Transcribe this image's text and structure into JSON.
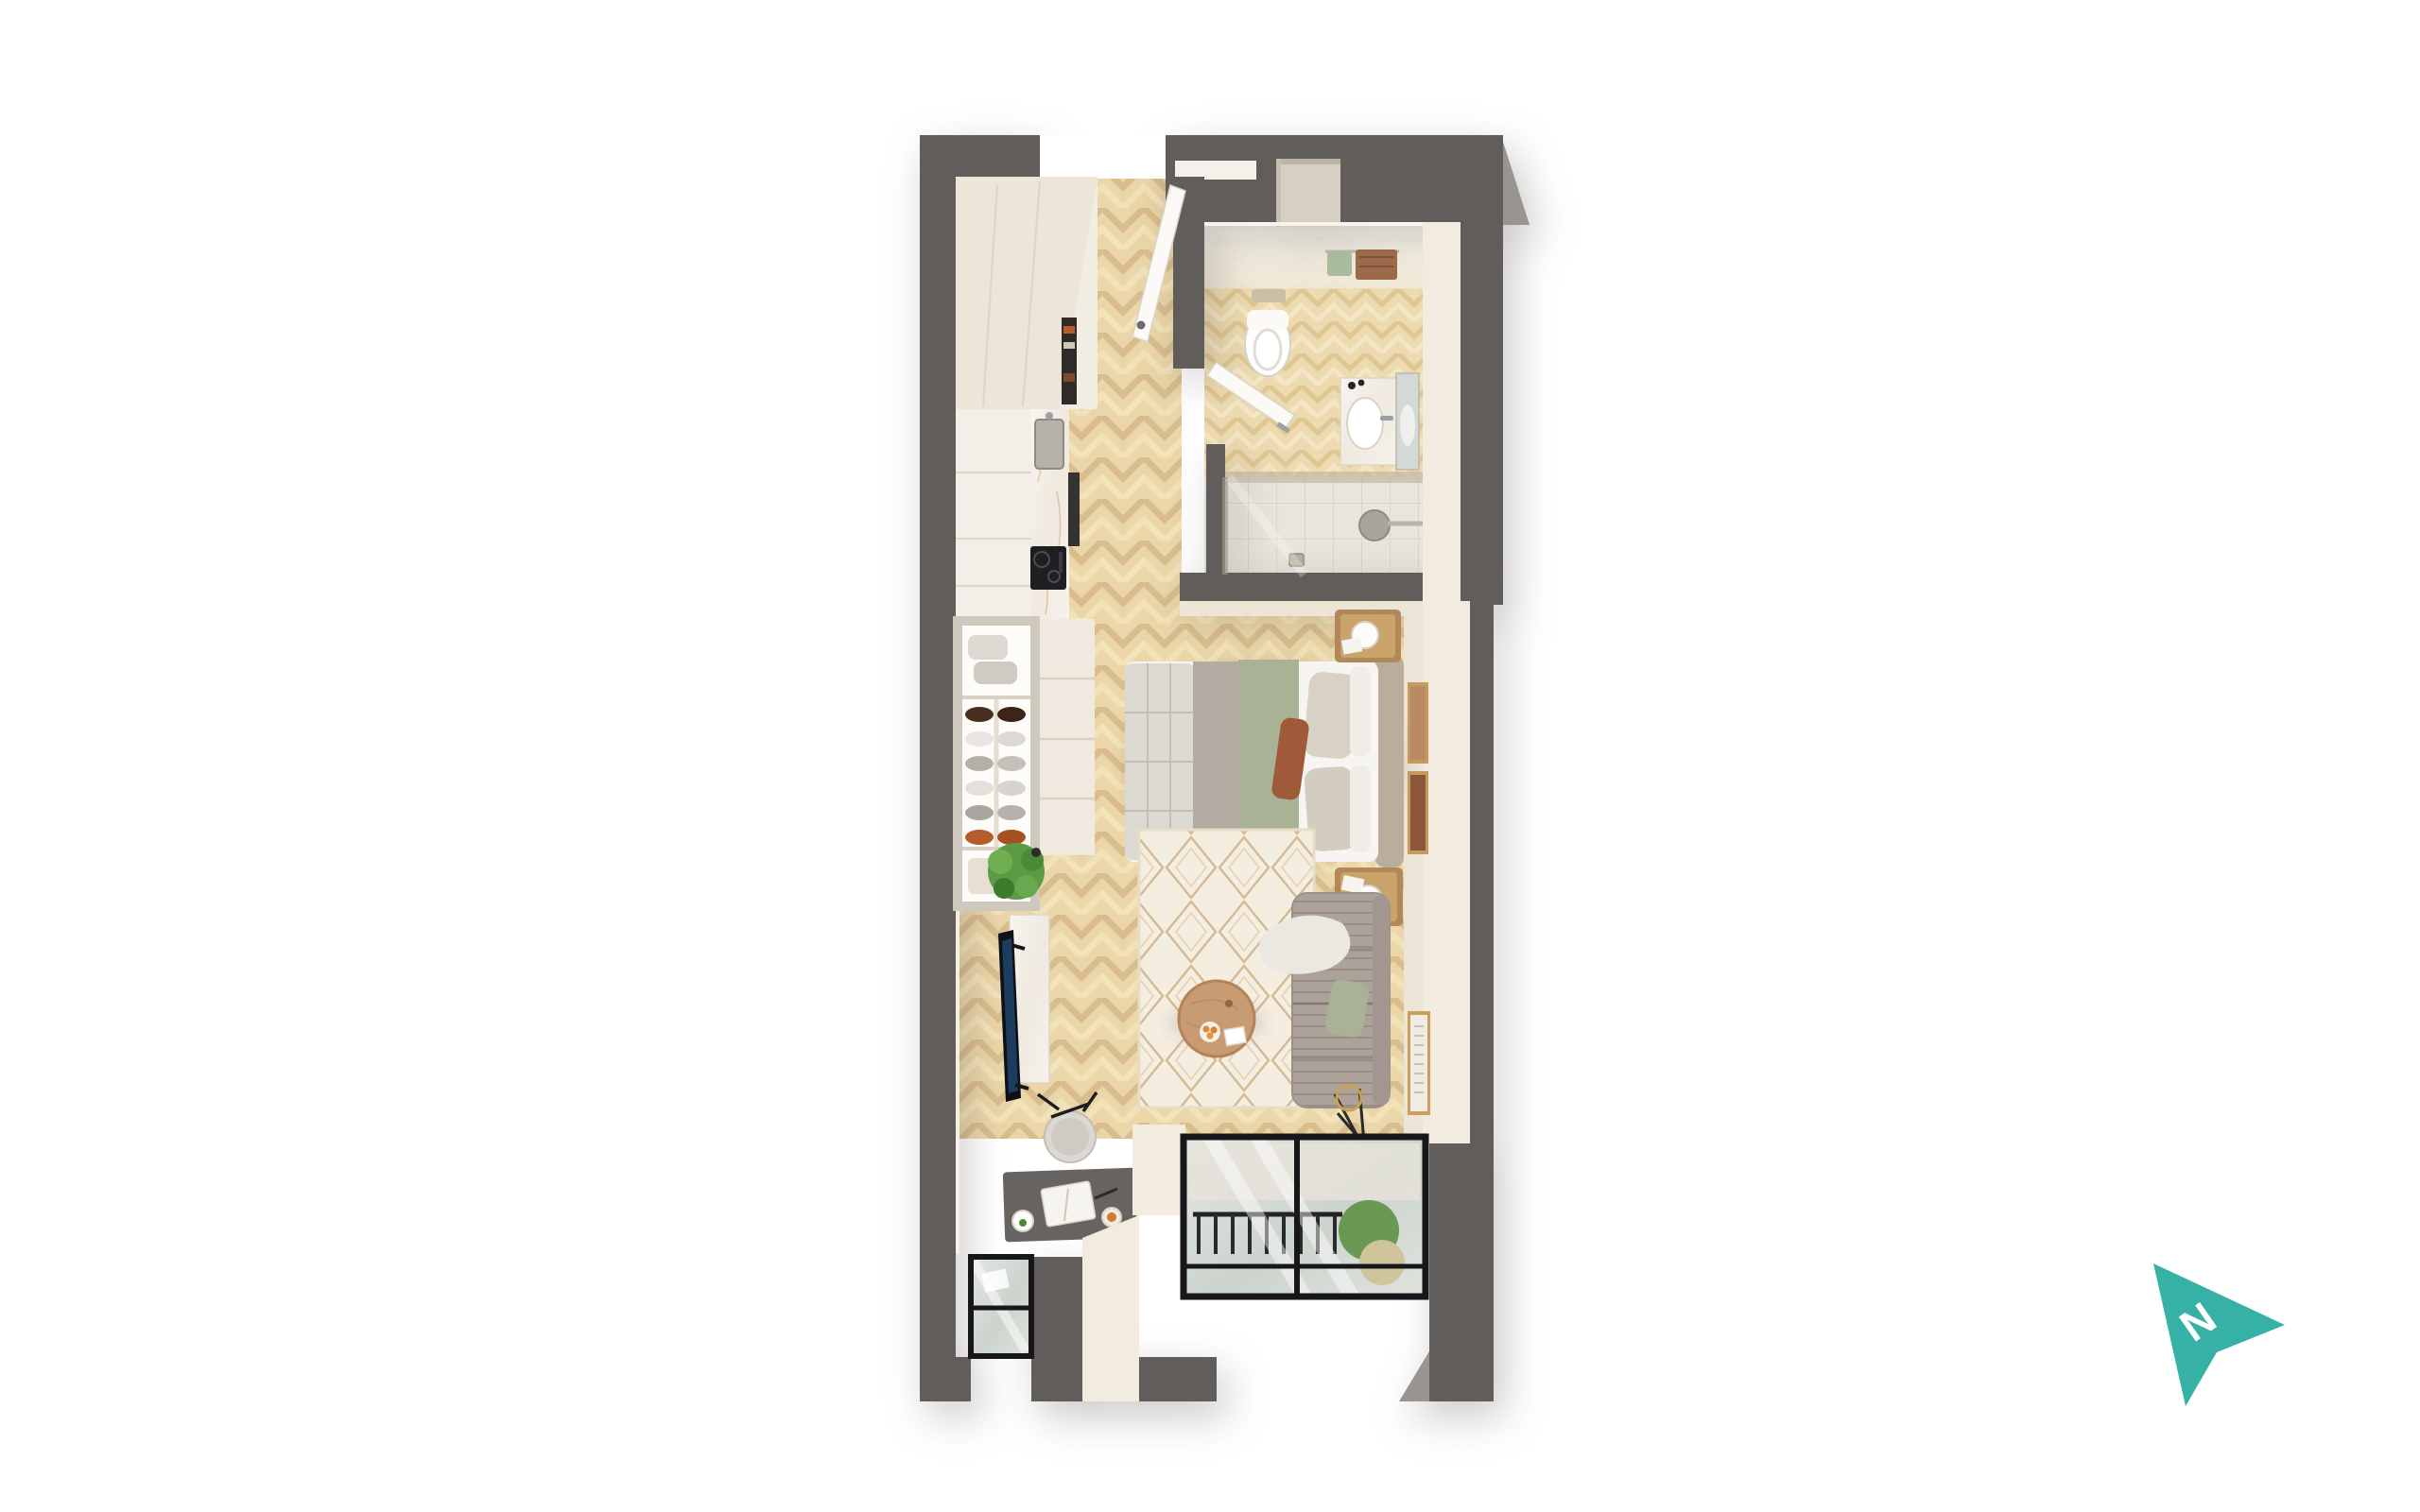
{
  "scene": {
    "type": "3d-floor-plan-render",
    "description": "Top-down 3D render of a studio apartment on a white background",
    "compass": {
      "label": "N",
      "pointing": "right",
      "color": "#35b2a5"
    }
  },
  "palette": {
    "wall-dark": "#615d5a",
    "wall-bevel": "#98948f",
    "cream-light": "#f1ebe0",
    "cream-mid": "#e6decf",
    "wood-floor": "#ead6a8",
    "bath-floor": "#ecdab0",
    "shower-tile": "#e9e5dc",
    "marble": "#f6f2ec",
    "rug": "#f4eee1",
    "rug-lattice": "#c9a883",
    "sofa-gray": "#aca29a",
    "bed-white": "#f7f5f1",
    "sage-green": "#a9b295",
    "rust": "#9f5a39",
    "table-wood": "#c99b72",
    "plant-green": "#5d9a44",
    "tv-screen": "#1d3d5e",
    "accent-teal": "#35b2a5",
    "glass": "#d6dcd7",
    "frame-black": "#17171a"
  },
  "rooms": [
    {
      "name": "entry-hall",
      "floor": "herringbone-wood",
      "items": [
        "entry-door-open",
        "closet-door-open",
        "hall-closet",
        "shelf-niche"
      ]
    },
    {
      "name": "kitchen",
      "floor": "herringbone-wood",
      "items": [
        "tall-cabinets",
        "marble-counter",
        "sink",
        "faucet",
        "induction-hob",
        "utensil-panel"
      ]
    },
    {
      "name": "bathroom",
      "floor": "wood-and-tile",
      "items": [
        "toilet",
        "flush-plate",
        "towel-rail",
        "towels",
        "vanity-sink",
        "mirror",
        "walk-in-shower",
        "shower-head",
        "floor-drain",
        "glass-screen",
        "bathroom-door-open",
        "wall-niche",
        "high-window"
      ]
    },
    {
      "name": "sleeping-area",
      "floor": "herringbone-wood",
      "items": [
        "double-bed",
        "sage-throw",
        "gray-blanket",
        "pillows",
        "headboard",
        "nightstand-top",
        "nightstand-bottom",
        "globe-lamps",
        "wall-art-two-frames",
        "open-wardrobe",
        "shoe-shelves",
        "folded-clothes",
        "drawer-dresser"
      ]
    },
    {
      "name": "living-area",
      "floor": "herringbone-wood",
      "items": [
        "diamond-rug",
        "round-coffee-table",
        "fruit-bowl",
        "photo-card",
        "sofa",
        "sage-cushion",
        "white-throw",
        "floor-lamp",
        "tv",
        "media-console",
        "potted-plant",
        "desk",
        "stool",
        "notebook",
        "coffee-cup",
        "wall-art-print"
      ]
    },
    {
      "name": "balcony-bay",
      "floor": "stone-tile",
      "items": [
        "sliding-glass-window",
        "railing",
        "hanging-plant",
        "pouf",
        "small-window"
      ]
    }
  ],
  "counts": {
    "shoe-rows": 6,
    "bed-pillows": 5,
    "window-bays": 2
  }
}
